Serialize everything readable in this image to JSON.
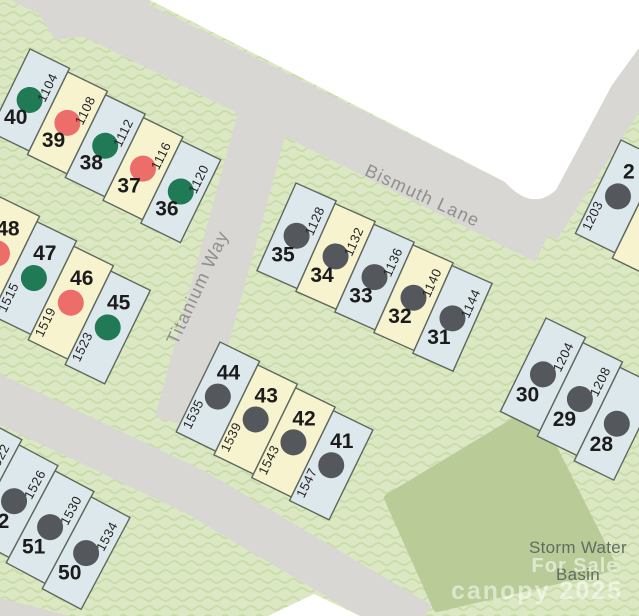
{
  "map": {
    "streets": [
      {
        "name": "Bismuth Lane"
      },
      {
        "name": "Titanium Way"
      }
    ],
    "basin": {
      "label_line1": "Storm Water",
      "label_line2": "Basin"
    },
    "watermark": {
      "for_sale": "For Sale",
      "brand_year": "canopy 2025"
    },
    "colors": {
      "lot_blue": "#dde8ed",
      "lot_yellow": "#f8f3cf",
      "dot_green": "#207a55",
      "dot_red": "#ed6d6a",
      "dot_gray": "#54585c",
      "road": "#d9d7d3",
      "green_background": "#dce8c4",
      "green_wave": "#c9dba8",
      "basin_fill": "#b9cc98",
      "lot_border": "#5d685d"
    },
    "blocks": [
      {
        "id": "A",
        "lots": [
          {
            "number": "40",
            "address": "1104",
            "fill": "blue",
            "dot": "green"
          },
          {
            "number": "39",
            "address": "1108",
            "fill": "yellow",
            "dot": "red"
          },
          {
            "number": "38",
            "address": "1112",
            "fill": "blue",
            "dot": "green"
          },
          {
            "number": "37",
            "address": "1116",
            "fill": "yellow",
            "dot": "red"
          },
          {
            "number": "36",
            "address": "1120",
            "fill": "blue",
            "dot": "green"
          }
        ]
      },
      {
        "id": "B",
        "lots": [
          {
            "number": "48",
            "address": "",
            "fill": "yellow",
            "dot": "red"
          },
          {
            "number": "47",
            "address": "1515",
            "fill": "blue",
            "dot": "green"
          },
          {
            "number": "46",
            "address": "1519",
            "fill": "yellow",
            "dot": "red"
          },
          {
            "number": "45",
            "address": "1523",
            "fill": "blue",
            "dot": "green"
          }
        ]
      },
      {
        "id": "C",
        "lots": [
          {
            "number": "35",
            "address": "1128",
            "fill": "blue",
            "dot": "gray"
          },
          {
            "number": "34",
            "address": "1132",
            "fill": "yellow",
            "dot": "gray"
          },
          {
            "number": "33",
            "address": "1136",
            "fill": "blue",
            "dot": "gray"
          },
          {
            "number": "32",
            "address": "1140",
            "fill": "yellow",
            "dot": "gray"
          },
          {
            "number": "31",
            "address": "1144",
            "fill": "blue",
            "dot": "gray"
          }
        ]
      },
      {
        "id": "D",
        "lots": [
          {
            "number": "44",
            "address": "1535",
            "fill": "blue",
            "dot": "gray"
          },
          {
            "number": "43",
            "address": "1539",
            "fill": "yellow",
            "dot": "gray"
          },
          {
            "number": "42",
            "address": "1543",
            "fill": "yellow",
            "dot": "gray"
          },
          {
            "number": "41",
            "address": "1547",
            "fill": "blue",
            "dot": "gray"
          }
        ]
      },
      {
        "id": "E",
        "lots": [
          {
            "number": "",
            "address": "1522",
            "fill": "blue",
            "dot": "gray"
          },
          {
            "number": "52",
            "address": "1526",
            "fill": "blue",
            "dot": "gray"
          },
          {
            "number": "51",
            "address": "1530",
            "fill": "blue",
            "dot": "gray"
          },
          {
            "number": "50",
            "address": "1534",
            "fill": "blue",
            "dot": "gray"
          }
        ]
      },
      {
        "id": "F",
        "lots": [
          {
            "number": "30",
            "address": "1204",
            "fill": "blue",
            "dot": "gray"
          },
          {
            "number": "29",
            "address": "1208",
            "fill": "blue",
            "dot": "gray"
          },
          {
            "number": "28",
            "address": "",
            "fill": "blue",
            "dot": "gray"
          }
        ]
      },
      {
        "id": "G",
        "lots": [
          {
            "number": "2",
            "address": "1203",
            "fill": "blue",
            "dot": "gray"
          },
          {
            "number": "",
            "address": "",
            "fill": "yellow",
            "dot": ""
          }
        ]
      }
    ]
  }
}
